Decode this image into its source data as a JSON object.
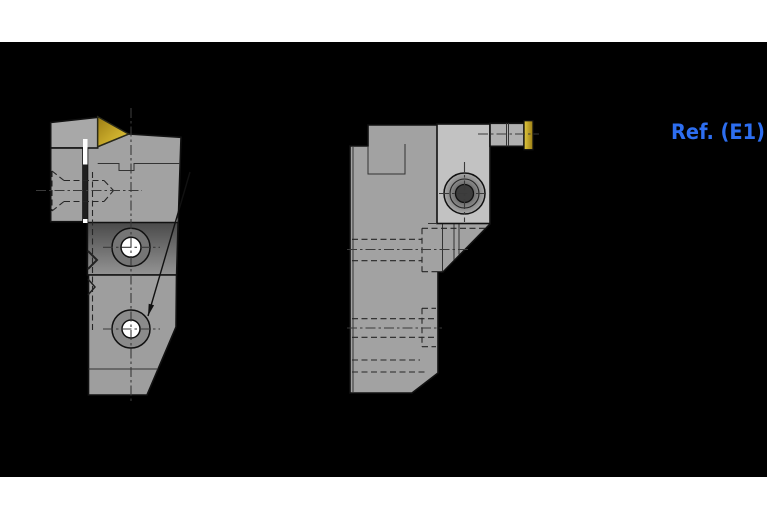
{
  "annotation": {
    "ref_label": "Ref. (E1)"
  },
  "colors": {
    "bg_black": "#000000",
    "page_white": "#ffffff",
    "body_gray": "#a2a2a2",
    "block_gray": "#9e9e9e",
    "bar_gray": "#a8a8a8",
    "clamp_light": "#c2c2c2",
    "insert_bar_gray": "#b0b0b0",
    "band_top": "#4a4a4a",
    "band_bottom": "#949494",
    "ring_dark": "#757575",
    "ring_mid": "#8b8b8b",
    "hole_white": "#ffffff",
    "gap_dark": "#1f1f1f",
    "gold_dark": "#9c7d14",
    "gold_mid": "#c7a92a",
    "gold_light": "#e0c83e",
    "boss_face": "#a8a8a8",
    "boss_mid": "#7a7a7a",
    "boss_socket": "#3d3d3d",
    "outline": "#111111",
    "inner_line": "#333333",
    "hidden": "#262626",
    "centerline": "#3a3a3a",
    "ref_blue": "#2d6ef0"
  }
}
